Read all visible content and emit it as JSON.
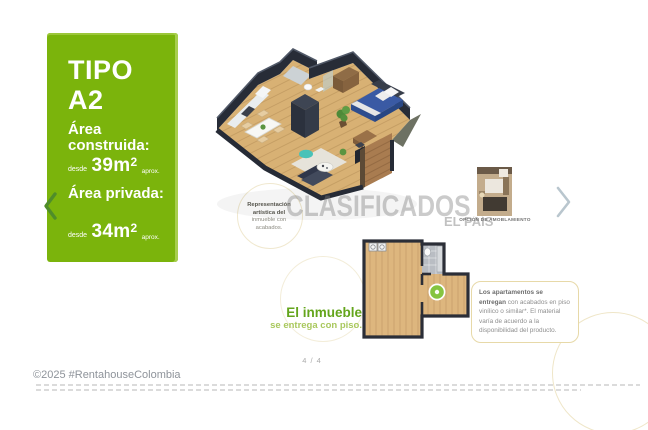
{
  "panel": {
    "title": "TIPO",
    "type": "A2",
    "built": {
      "label": "Área construida:",
      "desde": "desde",
      "value": "39m",
      "sup": "2",
      "aprox": "aprox."
    },
    "private": {
      "label": "Área privada:",
      "desde": "desde",
      "value": "34m",
      "sup": "2",
      "aprox": "aprox."
    }
  },
  "plan3d_caption": {
    "lines": [
      "Representación",
      "artística del",
      "inmueble con",
      "acabados."
    ]
  },
  "watermark": {
    "line1": "CLASIFICADOS",
    "line2": "EL PAÍS"
  },
  "thumbnail": {
    "caption": "OPCIÓN DE AMOBLAMIENTO"
  },
  "floor_note": {
    "title": "El inmueble",
    "subtitle": "se entrega con piso."
  },
  "callout": {
    "bold": "Los apartamentos se entregan",
    "rest": " con acabados en piso vinílico o similar*. El material varía de acuerdo a la disponibilidad del producto."
  },
  "pagination": {
    "current": "4 / 4"
  },
  "footer": {
    "copyright": "©2025 #RentahouseColombia"
  },
  "nav": {
    "prev_icon": "chevron-left",
    "next_icon": "chevron-right"
  },
  "colors": {
    "panel_green": "#7bb40c",
    "note_green": "#64a51c",
    "marker_green": "#85c440",
    "callout_border": "#e7d9a8",
    "watermark_gray": "#7d7d7d"
  }
}
